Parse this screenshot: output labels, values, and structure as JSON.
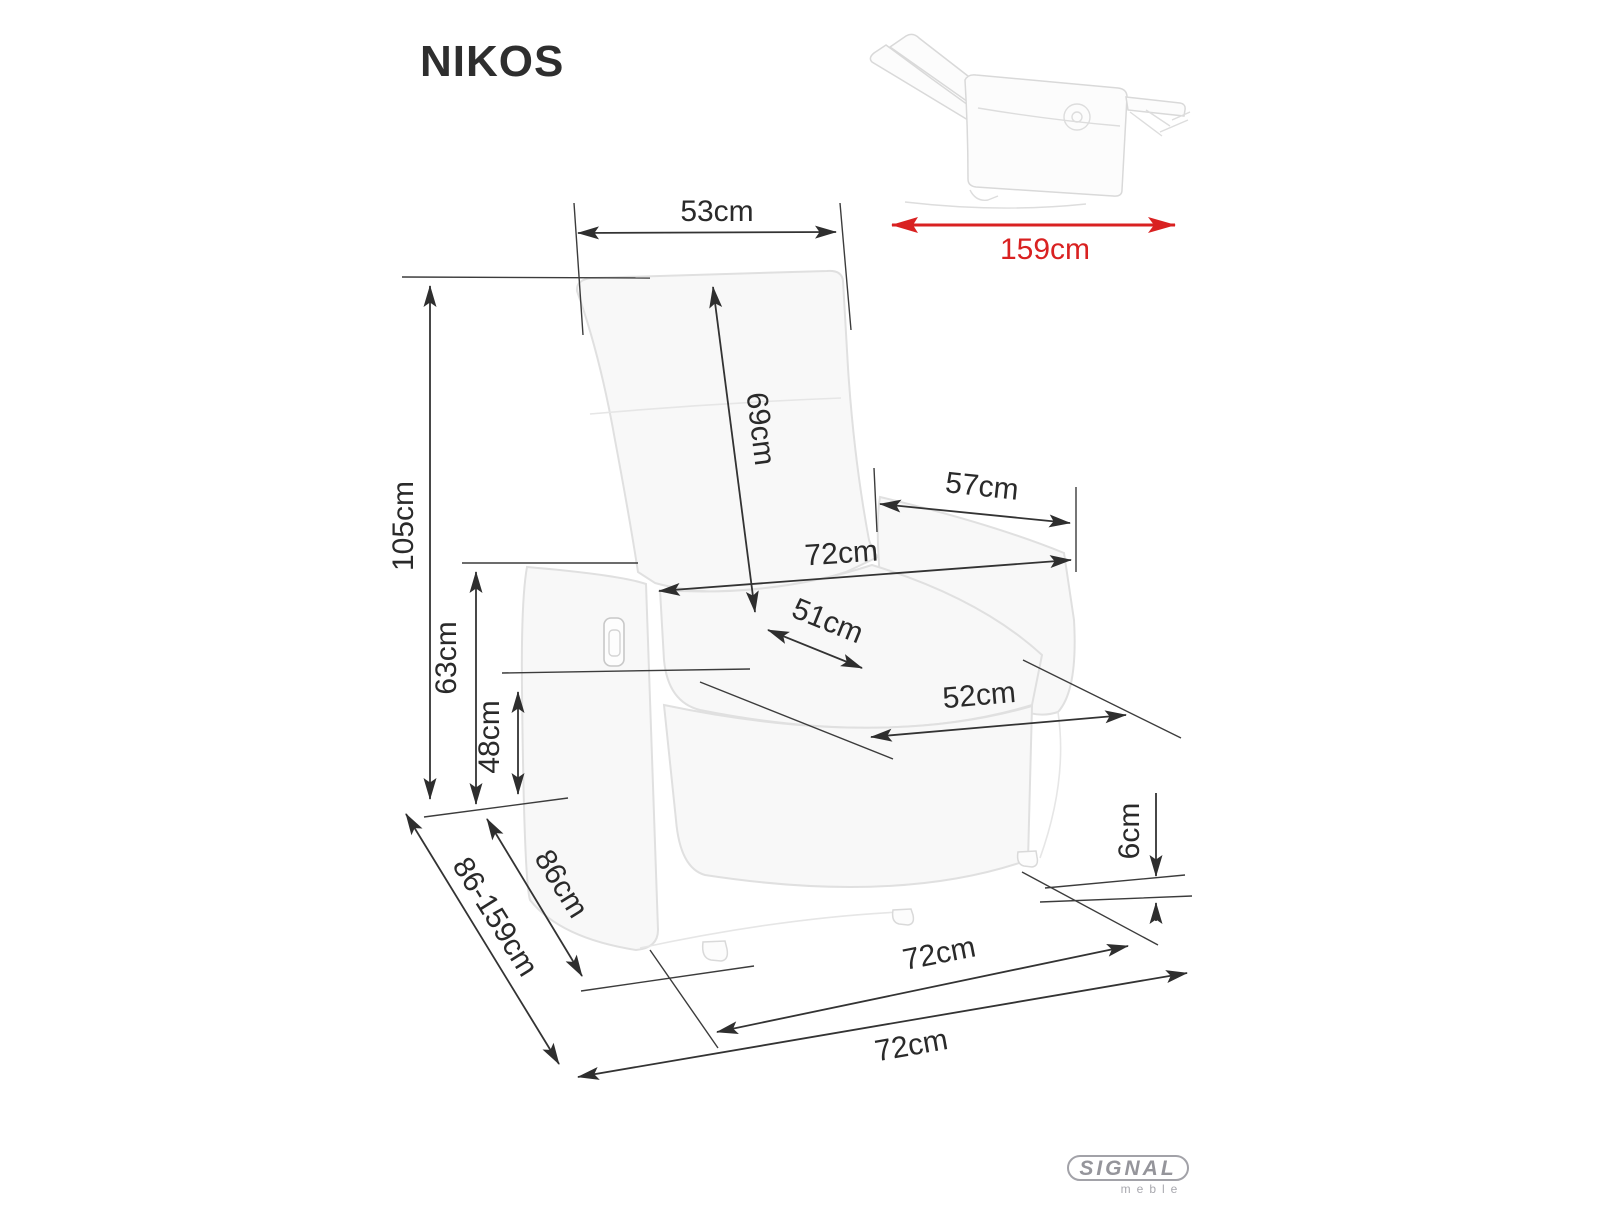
{
  "title": "NIKOS",
  "colors": {
    "ink": "#2a2a2a",
    "accent_red": "#d92121",
    "ghost_gray": "#e0e0e0",
    "logo_gray": "#95959b"
  },
  "dimensions": {
    "top_width": "53cm",
    "backrest_height": "69cm",
    "total_height": "105cm",
    "armrest_height": "63cm",
    "seat_height": "48cm",
    "armrest_depth": "57cm",
    "width_upper": "72cm",
    "seat_depth": "51cm",
    "seat_width": "52cm",
    "foot_clearance": "6cm",
    "depth": "86cm",
    "depth_extended": "86-159cm",
    "width_mid": "72cm",
    "width_base": "72cm",
    "length_reclined": "159cm"
  },
  "logo": {
    "brand": "SIGNAL",
    "tagline": "meble"
  }
}
